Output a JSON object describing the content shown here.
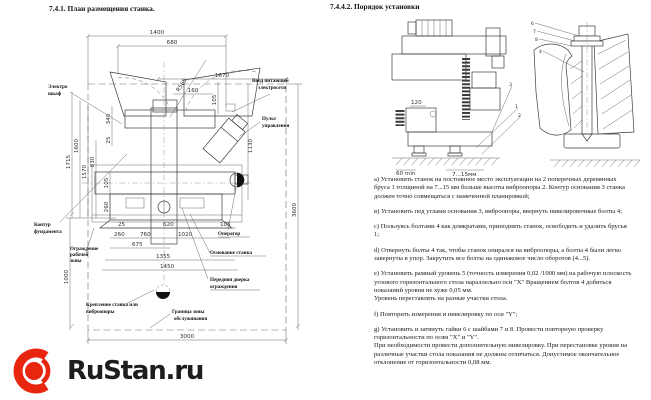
{
  "header": {
    "left_title": "7.4.1. План размещения станка.",
    "right_title": "7.4.4.2. Порядок установки"
  },
  "plan_drawing": {
    "dims": {
      "w1400": "1400",
      "w680": "680",
      "r565": "R565",
      "w1670": "1670",
      "w160": "160",
      "h105top": "105",
      "h340": "340",
      "h25": "25",
      "h830": "830",
      "h1570": "1570",
      "h1600": "1600",
      "h1715": "1715",
      "h105mid": "105",
      "h260": "260",
      "b25": "25",
      "b620": "620",
      "b105": "105",
      "b260": "260",
      "b760": "760",
      "b1020": "1020",
      "b675": "675",
      "b1355": "1355",
      "b1450": "1450",
      "h1000": "1000",
      "h1130": "1130",
      "h3600": "3600",
      "b3000": "3000"
    },
    "labels": {
      "electro1": "Электро",
      "electro2": "шкаф",
      "power1": "Ввод питающей",
      "power2": "электросети",
      "panel1": "Пульт",
      "panel2": "управления",
      "foundation1": "Контур",
      "foundation2": "фундамента",
      "operator": "Оператор",
      "base": "Основание станка",
      "guard1": "Ограждение",
      "guard2": "рабочей",
      "guard3": "зоны",
      "door1": "Передняя дверка",
      "door2": "ограждения",
      "mount1": "Крепление станка или",
      "mount2": "виброопоры",
      "zone1": "Граница зоны",
      "zone2": "обслуживания"
    }
  },
  "install_drawing": {
    "dims": {
      "d120": "120",
      "d60": "60 min",
      "d715": "7...15мм"
    },
    "callouts": {
      "n1": "1",
      "n2": "2",
      "n3": "3",
      "n4": "4",
      "n6": "6",
      "n7": "7",
      "n8": "8"
    }
  },
  "instructions": {
    "paragraphs": [
      "а) Установить станок на постоянное место эксплуатации на 2 поперечных деревянных бруса 1 толщиной на 7...15 мм больше высоты виброопоры 2. Контур основания 3 станка должен точно совмещаться с намеченной планировкой;",
      "в) Установить под углами основания 3, виброопоры, ввернуть нивелировочные болты 4;",
      "с) Пользуясь болтами 4 как домкратами, приподнять станок, освободить и удалить брусья 1;",
      "d) Отвернуть болты 4 так, чтобы станок опирался на виброопоры, а болты 4 были легко завернуты в упор. Закрутить все болты на одинаковое число оборотов (4...5).",
      "е) Установить рамный уровень 5 (точность измерения 0,02 /1000 мм) на рабочую плоскость углового горизонтального стола параллельно оси \"X\" Вращением болтов 4 добиться показаний уровня не хуже 0,05 мм.\nУровень переставлять на разные участки стола.",
      "f) Повторить измерения и нивелировку по оси \"Y\";",
      "g) Установить и затянуть гайки 6 с шайбами 7 и 8. Провести повторную проверку горизонтальности по осям \"X\" и \"Y\".\nПри необходимости провести дополнительную нивелировку. При перестановке уровня на различные участки стола показания не должны отличаться. Допустимое окончательное отклонение от горизонтальности 0,08 мм."
    ]
  },
  "logo": {
    "text": "RuStan.ru",
    "accent": "#e8250f",
    "text_color": "#1d1d1d"
  }
}
